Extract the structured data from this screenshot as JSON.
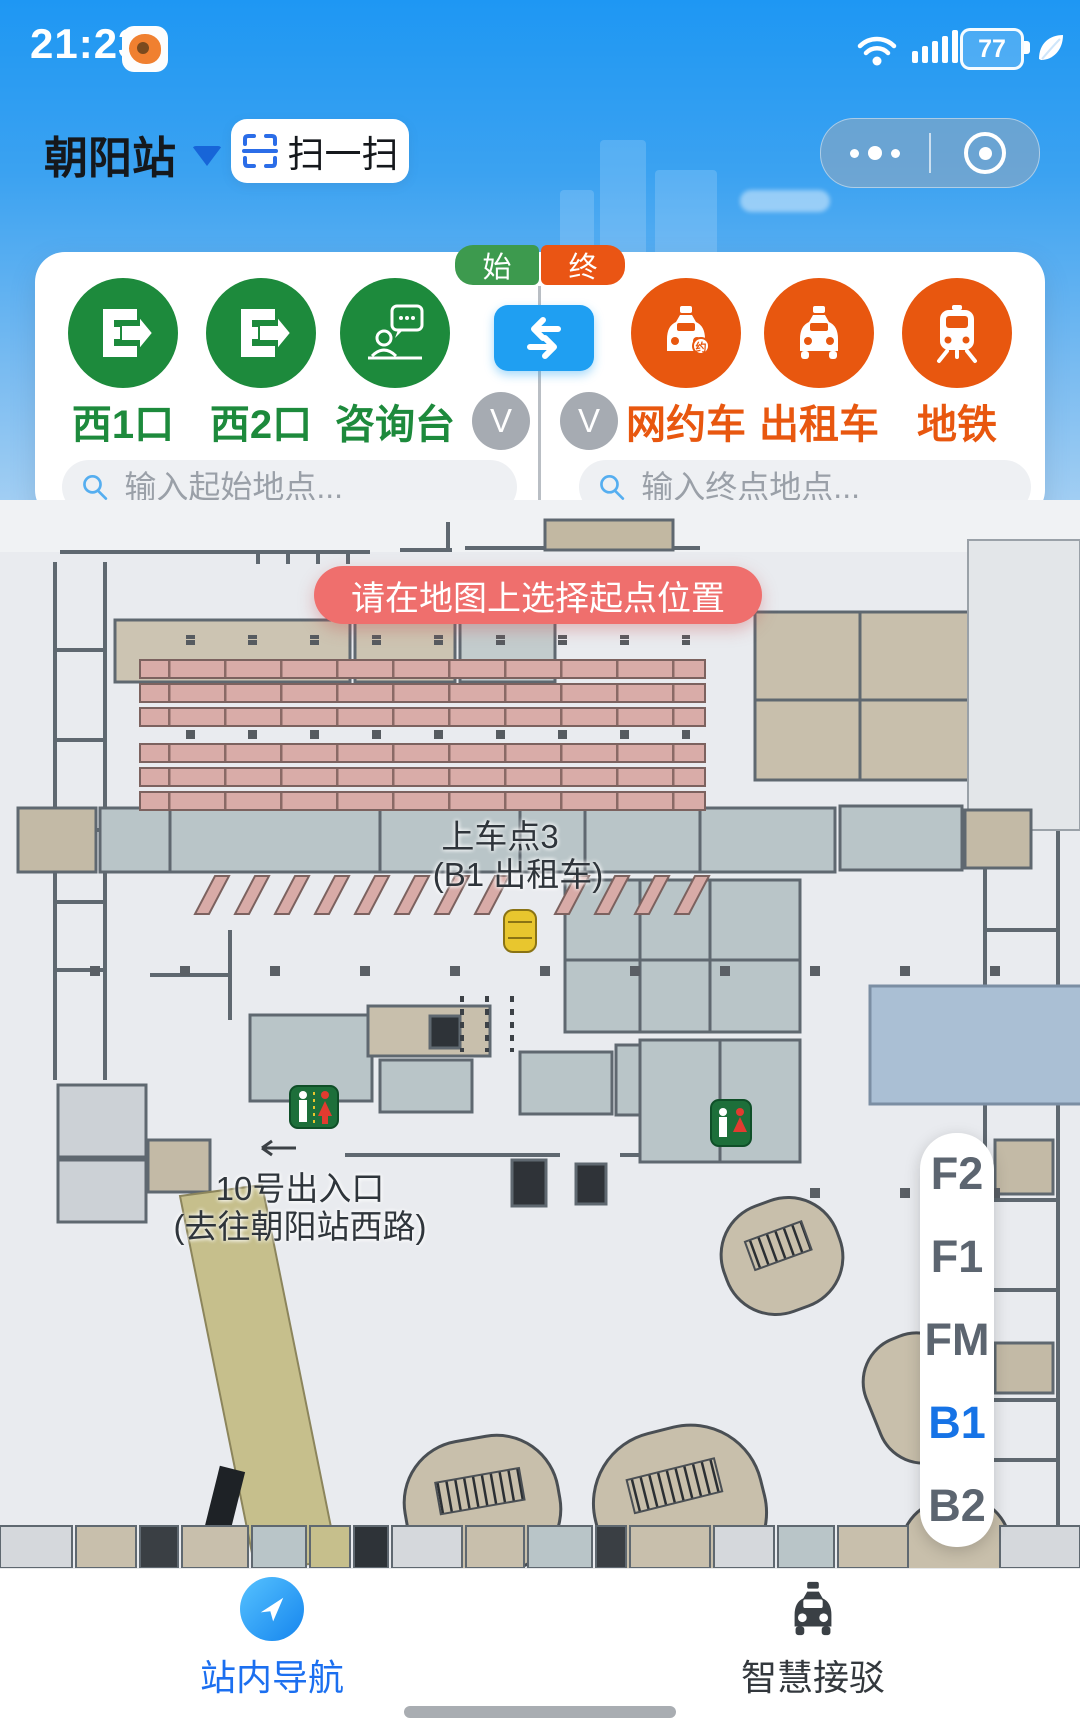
{
  "status_bar": {
    "time": "21:23",
    "battery_percent": "77"
  },
  "header": {
    "station_name": "朝阳站",
    "scan_label": "扫一扫"
  },
  "route_panel": {
    "start_tag": "始",
    "end_tag": "终",
    "start_shortcuts": [
      {
        "label": "西1口"
      },
      {
        "label": "西2口"
      },
      {
        "label": "咨询台"
      }
    ],
    "end_shortcuts": [
      {
        "label": "网约车"
      },
      {
        "label": "出租车"
      },
      {
        "label": "地铁"
      }
    ],
    "collapse_label": "V",
    "start_input_placeholder": "输入起始地点...",
    "end_input_placeholder": "输入终点地点..."
  },
  "toast": {
    "message": "请在地图上选择起点位置"
  },
  "map": {
    "pickup_label_line1": "上车点3",
    "pickup_label_line2": "(B1 出租车)",
    "exit_label_line1": "10号出入口",
    "exit_label_line2": "(去往朝阳站西路)"
  },
  "floor_selector": {
    "floors": [
      "F2",
      "F1",
      "FM",
      "B1",
      "B2"
    ],
    "active_floor": "B1"
  },
  "bottom_nav": {
    "tabs": [
      {
        "label": "站内导航"
      },
      {
        "label": "智慧接驳"
      }
    ]
  },
  "colors": {
    "start_accent": "#1d8a3c",
    "end_accent": "#e8570f",
    "swap_blue": "#1f9ff2",
    "tag_start": "#3d9a4e",
    "tag_end": "#ea5514",
    "toast_bg": "#ef6f6d",
    "floor_active": "#1673e6",
    "active_tab": "#1b6ff0"
  }
}
